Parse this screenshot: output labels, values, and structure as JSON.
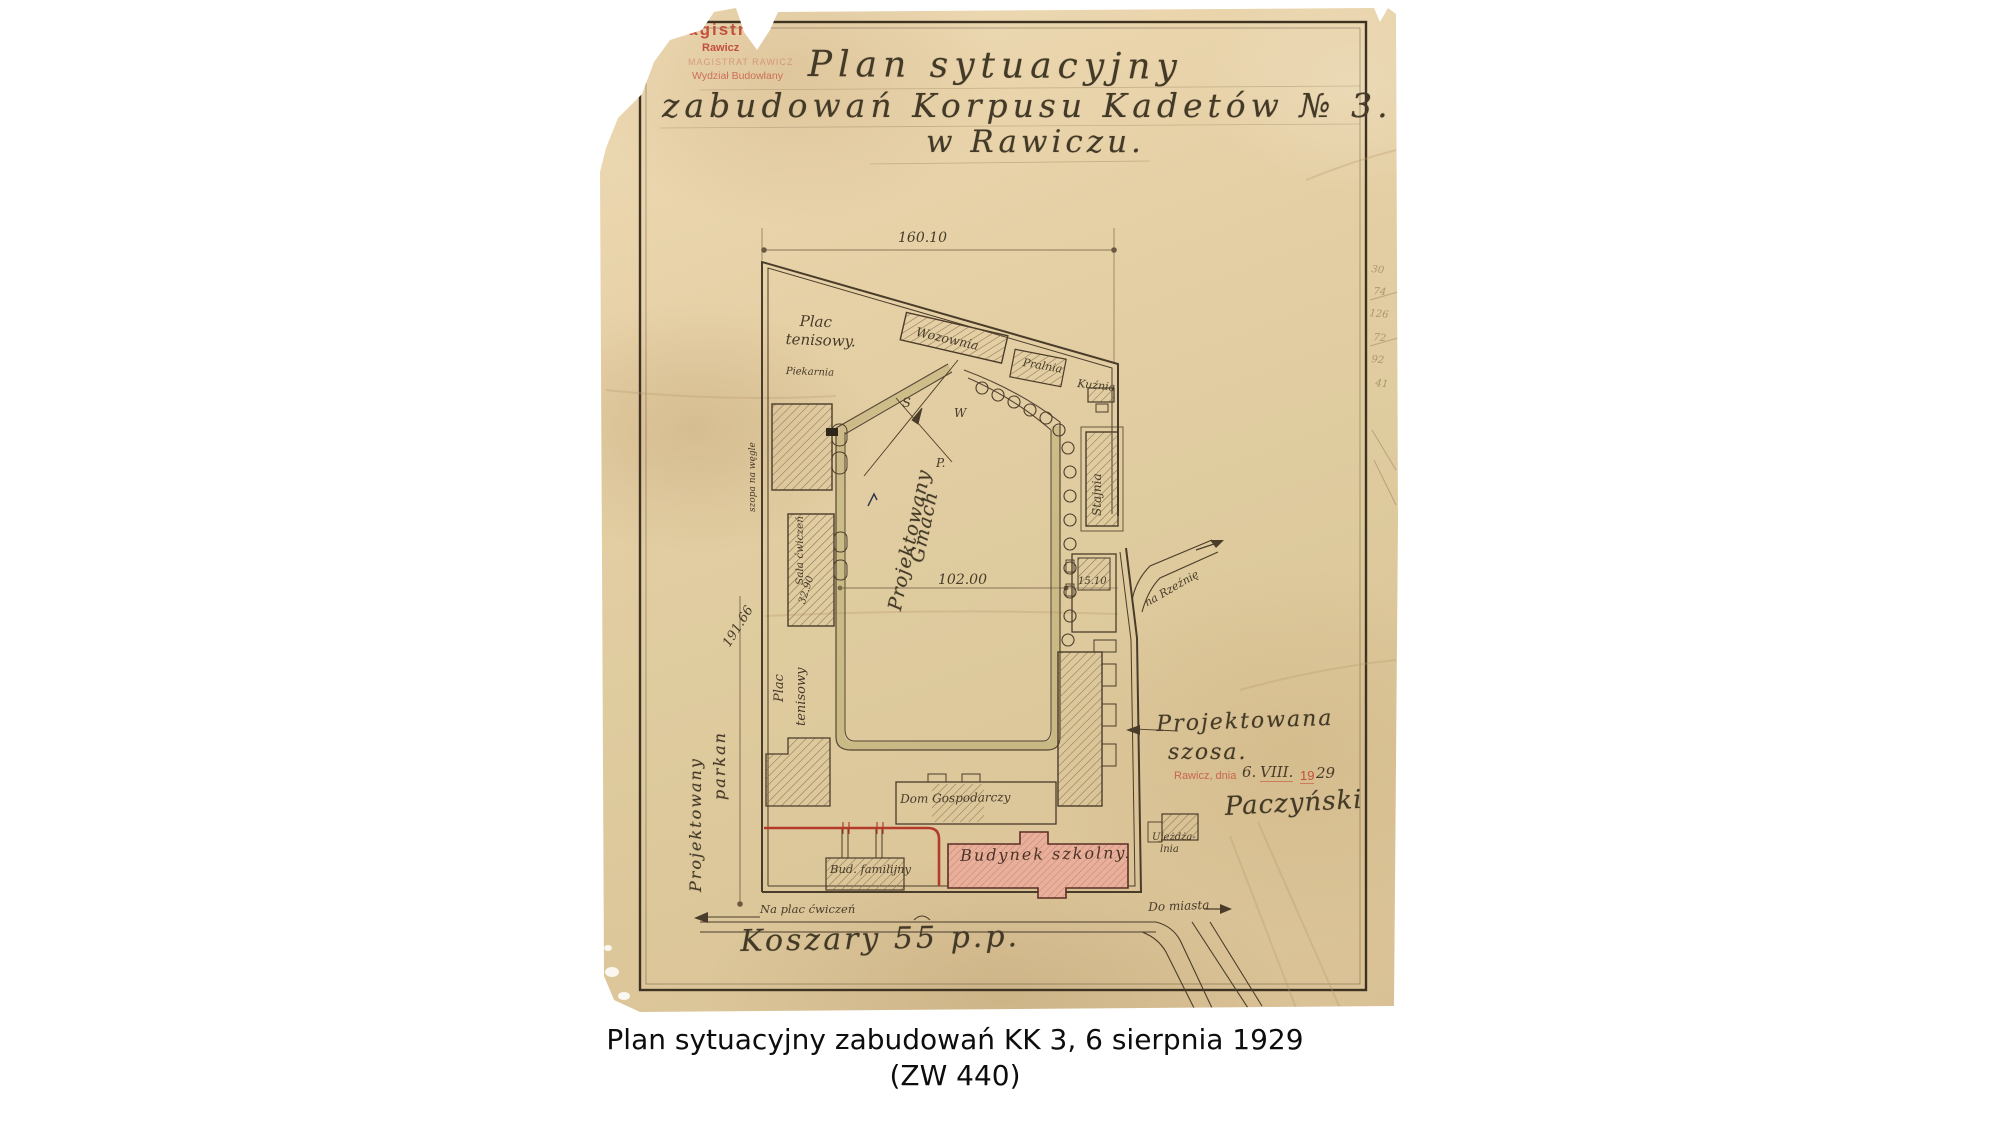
{
  "caption": {
    "line1": "Plan sytuacyjny zabudowań KK 3, 6 sierpnia 1929",
    "line2": "(ZW 440)"
  },
  "stamp": {
    "line1": "Magistrat",
    "line2": "Rawicz",
    "line3": "MAGISTRAT RAWICZ",
    "line4": "Wydział Budowlany"
  },
  "title": {
    "line1": "Plan sytuacyjny",
    "line2": "zabudowań Korpusu Kadetów № 3.",
    "line3": "w Rawiczu."
  },
  "date_stamp": {
    "prefix": "Rawicz, dnia",
    "day": "6.",
    "month": "VIII.",
    "year_print": "19",
    "year_hand": "29"
  },
  "signature": "Paczyński",
  "dimensions": {
    "top": "160.10",
    "left": "191.66",
    "middle": "102.00",
    "east_building": "15.10",
    "gym": "32.90"
  },
  "compass": {
    "letter1": "S",
    "letter2": "W",
    "letter3": "P."
  },
  "plan_labels": {
    "plac_tenisowy_top_1": "Plac",
    "plac_tenisowy_top_2": "tenisowy.",
    "wozownia": "Wozownia",
    "pralnia": "Pralnia",
    "kuznia": "Kuźnia",
    "stajnia": "Stajnia",
    "piekarnia": "Piekarnia",
    "szopa_na_wegle": "szopa na węgle",
    "sala_cwiczen": "Sala ćwiczeń",
    "projektowany_gmach_1": "Projektowany",
    "projektowany_gmach_2": "Gmach",
    "plac_tenisowy_side_1": "Plac",
    "plac_tenisowy_side_2": "tenisowy",
    "projektowany_parkan_1": "Projektowany",
    "projektowany_parkan_2": "parkan",
    "dom_gospodarczy": "Dom Gospodarczy",
    "budynek_szkolny": "Budynek szkolny.",
    "bud_familijny": "Bud. familijny",
    "ujezdzalnia_1": "Ujeżdża-",
    "ujezdzalnia_2": "lnia",
    "na_rzeznie": "na Rzeźnię",
    "projektowana_szosa_1": "Projektowana",
    "projektowana_szosa_2": "szosa.",
    "na_plac_cwiczen": "Na plac ćwiczeń",
    "do_miasta": "Do miasta",
    "koszary": "Koszary 55 p.p."
  },
  "margin_notes": [
    "30",
    "74",
    "126",
    "72",
    "92",
    "41"
  ],
  "colors": {
    "paper": "#e3cda3",
    "ink": "#4a3c2a",
    "red_stamp": "#c4503c",
    "red_line": "#b43b2c",
    "pink_building": "#e8b09b"
  }
}
